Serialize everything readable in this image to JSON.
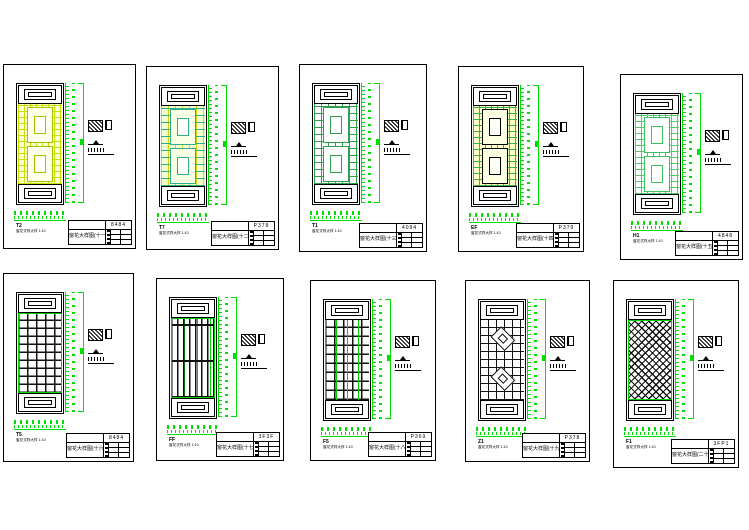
{
  "document": {
    "background_color": "#ffffff",
    "line_color": "#000000",
    "dimension_color": "#00e000",
    "sheet_count": 10,
    "layout": "2 rows of 5 CAD detail sheets, each showing one lattice window panel with dimensions, hatch legend and title block"
  },
  "sheets": [
    {
      "panel_code": "T2",
      "panel_label": "窗花式样大样 1:10",
      "title": "窗花大样图(十一)",
      "sheet_no": "8484",
      "lattice_color": "#c9e000",
      "pattern": "yellow double-frame lattice"
    },
    {
      "panel_code": "T7",
      "panel_label": "窗花式样大样 1:10",
      "title": "窗花大样图(十二)",
      "sheet_no": "P378",
      "lattice_color": "#2fae8f",
      "pattern": "teal and yellow lattice"
    },
    {
      "panel_code": "T1",
      "panel_label": "窗花式样大样 1:10",
      "title": "窗花大样图(十三)",
      "sheet_no": "4094",
      "lattice_color": "#2f9e4f",
      "pattern": "green rectangular lattice"
    },
    {
      "panel_code": "EF",
      "panel_label": "窗花式样大样 1:10",
      "title": "窗花大样图(十四)",
      "sheet_no": "P379",
      "lattice_color": "#38b24c",
      "pattern": "green lattice on yellow ground"
    },
    {
      "panel_code": "H1",
      "panel_label": "窗花式样大样 1:10",
      "title": "窗花大样图(十五)",
      "sheet_no": "4848",
      "lattice_color": "#52c96c",
      "pattern": "green square-grid lattice"
    },
    {
      "panel_code": "T5",
      "panel_label": "窗花式样大样 1:10",
      "title": "窗花大样图(十六)",
      "sheet_no": "8484",
      "lattice_color": "#111111",
      "pattern": "black orthogonal lattice with green border"
    },
    {
      "panel_code": "FF",
      "panel_label": "窗花式样大样 1:10",
      "title": "窗花大样图(十七)",
      "sheet_no": "3F3F",
      "lattice_color": "#111111",
      "pattern": "black vertical-slat lattice"
    },
    {
      "panel_code": "F5",
      "panel_label": "窗花式样大样 1:10",
      "title": "窗花大样图(十八)",
      "sheet_no": "P369",
      "lattice_color": "#111111",
      "pattern": "black meander lattice with green mullions"
    },
    {
      "panel_code": "Z1",
      "panel_label": "窗花式样大样 1:10",
      "title": "窗花大样图(十九)",
      "sheet_no": "P378",
      "lattice_color": "#111111",
      "pattern": "black lattice with diamond medallions"
    },
    {
      "panel_code": "F1",
      "panel_label": "窗花式样大样 1:10",
      "title": "窗花大样图(二十)",
      "sheet_no": "3FP1",
      "lattice_color": "#111111",
      "pattern": "black diagonal basketweave lattice"
    }
  ]
}
